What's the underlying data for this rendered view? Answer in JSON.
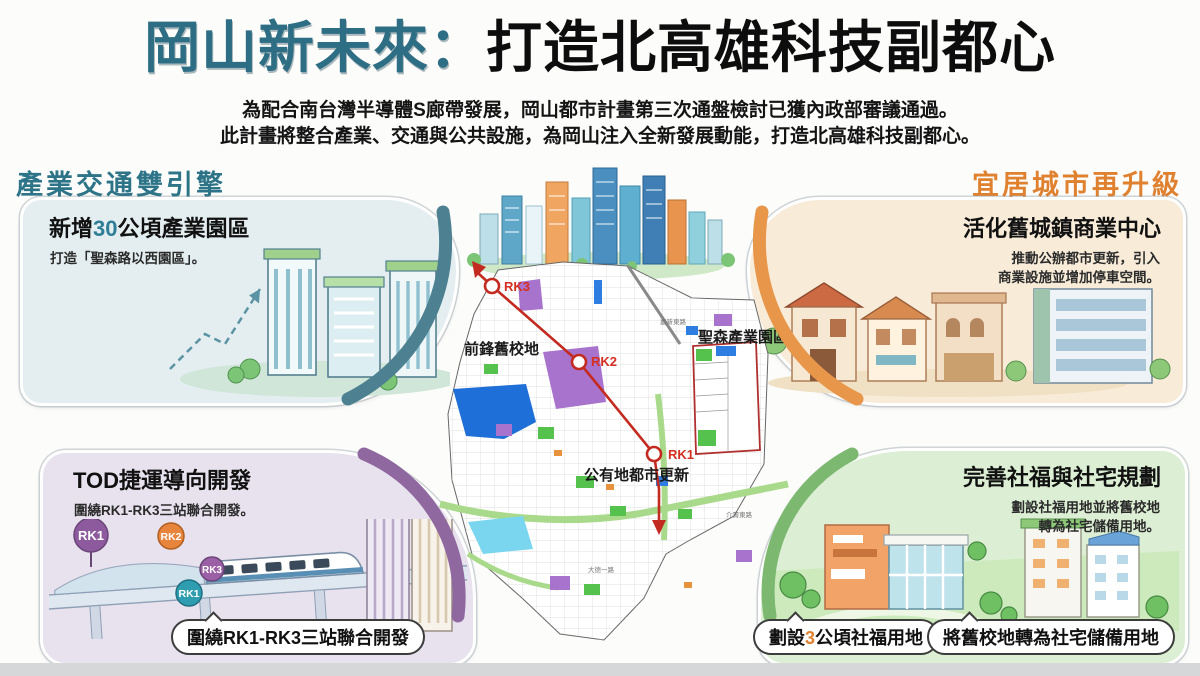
{
  "title": {
    "highlight": "岡山新未來：",
    "main": "打造北高雄科技副都心"
  },
  "intro": {
    "line1": "為配合南台灣半導體S廊帶發展，岡山都市計畫第三次通盤檢討已獲內政部審議通過。",
    "line2": "此計畫將整合產業、交通與公共設施，為岡山注入全新發展動能，打造北高雄科技副都心。"
  },
  "sections": {
    "industry": {
      "header": "產業交通雙引擎",
      "card_title_pre": "新增",
      "card_title_num": "30",
      "card_title_post": "公頃產業園區",
      "desc": "打造「聖森路以西園區」。"
    },
    "livable": {
      "header": "宜居城市再升級",
      "card_title": "活化舊城鎮商業中心",
      "desc_line1": "推動公辦都市更新，引入",
      "desc_line2": "商業設施並增加停車空間。"
    },
    "tod": {
      "card_title": "TOD捷運導向開發",
      "desc": "圍繞RK1-RK3三站聯合開發。",
      "station_badges": [
        "RK1",
        "RK2",
        "RK3",
        "RK1"
      ],
      "callout": "圍繞RK1-RK3三站聯合開發"
    },
    "welfare": {
      "card_title": "完善社福與社宅規劃",
      "desc_line1": "劃設社福用地並將舊校地",
      "desc_line2": "轉為社宅儲備用地。",
      "callout1_pre": "劃設",
      "callout1_num": "3",
      "callout1_post": "公頃社福用地",
      "callout2": "將舊校地轉為社宅儲備用地"
    }
  },
  "map": {
    "station_rk1": "RK1",
    "station_rk2": "RK2",
    "station_rk3": "RK3",
    "label_old_school": "前鋒舊校地",
    "label_industrial_park": "聖森產業園區",
    "label_urban_renewal": "公有地都市更新",
    "road_label_1": "嘉新東路",
    "road_label_2": "介壽東路",
    "road_label_3": "大德一路"
  },
  "colors": {
    "title_teal": "#2e6e85",
    "header_teal": "#2d7488",
    "header_orange": "#e0812f",
    "arc_teal": "#4d8191",
    "arc_orange": "#e8964a",
    "arc_purple": "#9068a0",
    "arc_green": "#7db871",
    "metro_red": "#c32b20",
    "map_blue": "#1e6fd8",
    "map_purple": "#a873cc",
    "map_green": "#55c24e",
    "badge_purple": "#8e5a9e",
    "badge_orange": "#e8853d",
    "badge_teal": "#2f9db0"
  }
}
